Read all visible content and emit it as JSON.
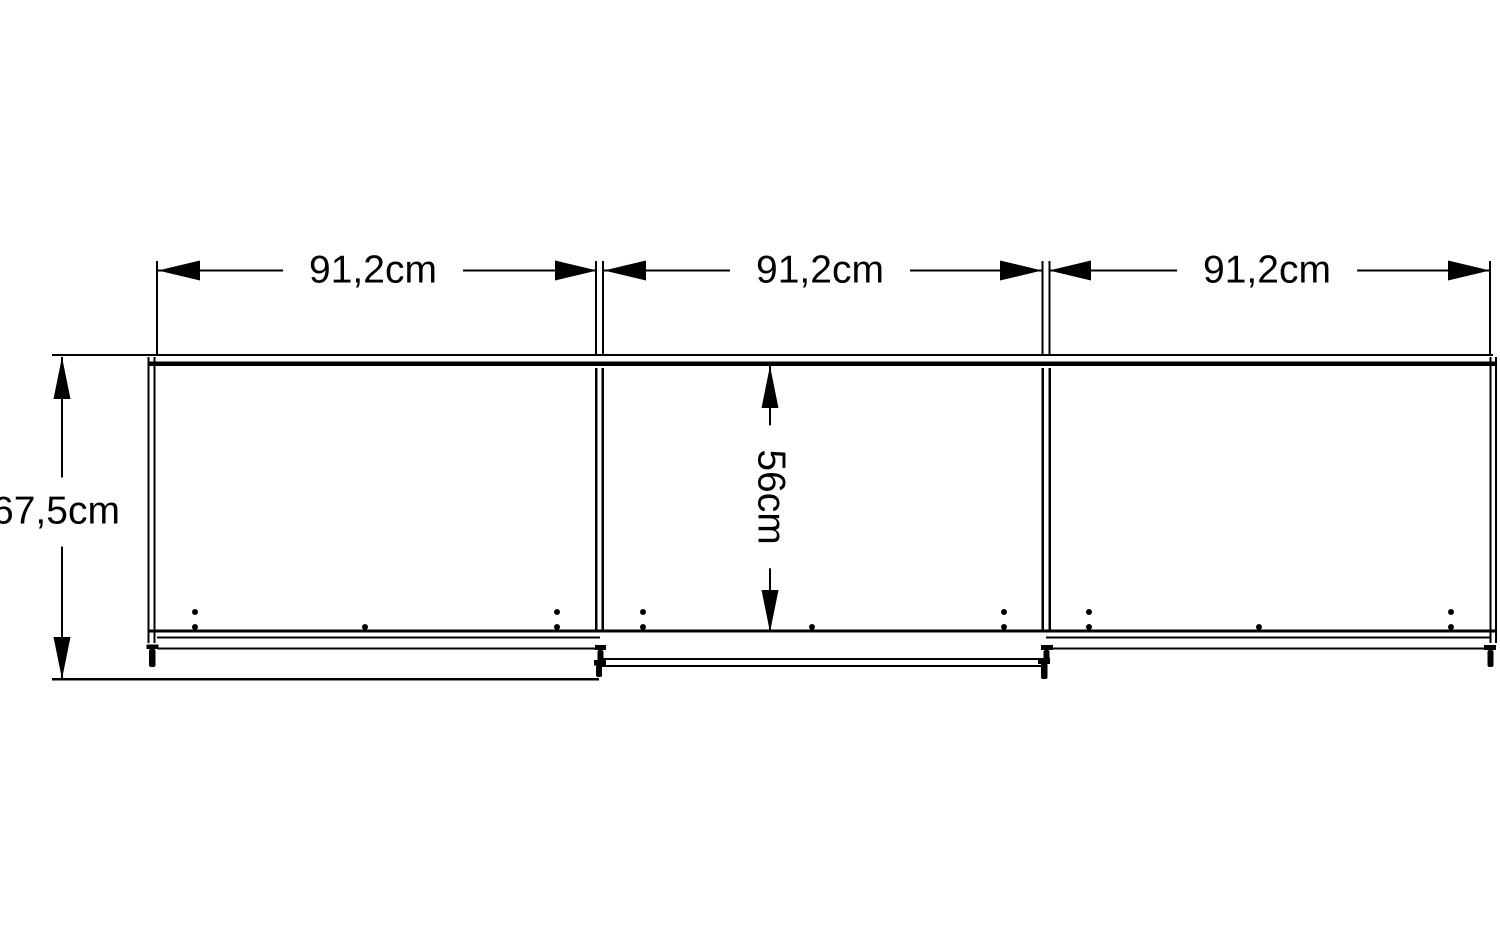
{
  "diagram": {
    "kind": "furniture-dimension-drawing",
    "dimensions": {
      "width_labels": [
        "91,2cm",
        "91,2cm",
        "91,2cm"
      ],
      "height_label": "67,5cm",
      "depth_label": "56cm",
      "widths_cm": [
        91.2,
        91.2,
        91.2
      ],
      "height_cm": 67.5,
      "depth_cm": 56
    },
    "colors": {
      "line": "#000000",
      "background": "#ffffff",
      "text": "#000000"
    }
  }
}
